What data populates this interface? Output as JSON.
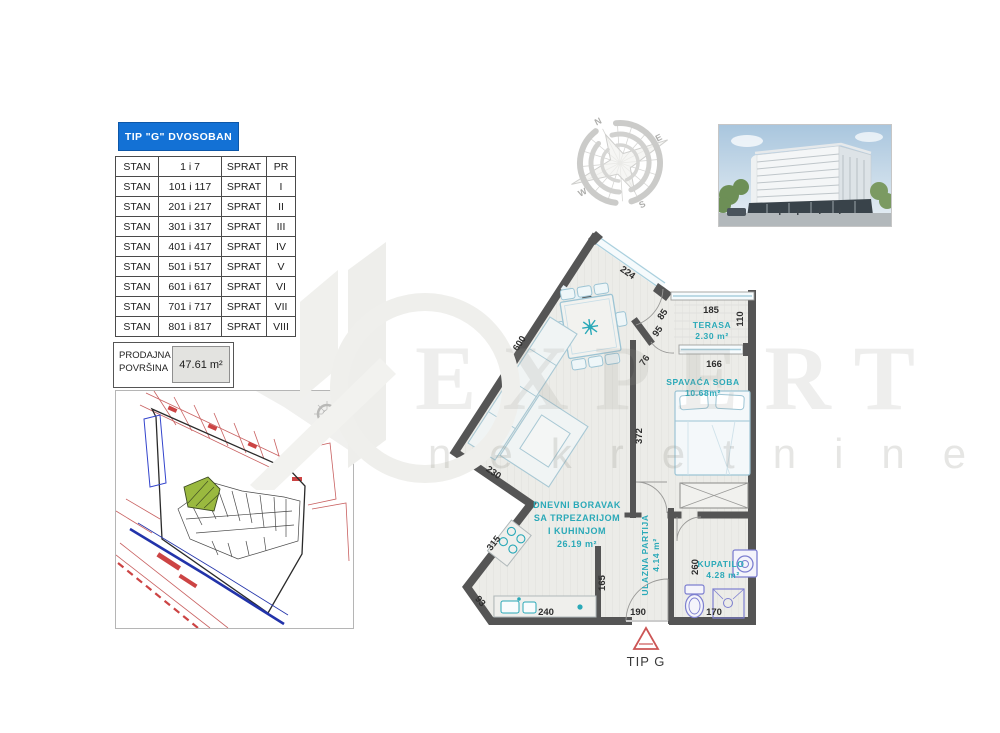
{
  "title_box": {
    "label": "TIP \"G\" DVOSOBAN"
  },
  "apartments_table": {
    "rows": [
      {
        "c1": "STAN",
        "c2": "1 i 7",
        "c3": "SPRAT",
        "c4": "PR"
      },
      {
        "c1": "STAN",
        "c2": "101 i 117",
        "c3": "SPRAT",
        "c4": "I"
      },
      {
        "c1": "STAN",
        "c2": "201 i 217",
        "c3": "SPRAT",
        "c4": "II"
      },
      {
        "c1": "STAN",
        "c2": "301 i 317",
        "c3": "SPRAT",
        "c4": "III"
      },
      {
        "c1": "STAN",
        "c2": "401 i 417",
        "c3": "SPRAT",
        "c4": "IV"
      },
      {
        "c1": "STAN",
        "c2": "501 i 517",
        "c3": "SPRAT",
        "c4": "V"
      },
      {
        "c1": "STAN",
        "c2": "601 i 617",
        "c3": "SPRAT",
        "c4": "VI"
      },
      {
        "c1": "STAN",
        "c2": "701 i 717",
        "c3": "SPRAT",
        "c4": "VII"
      },
      {
        "c1": "STAN",
        "c2": "801 i 817",
        "c3": "SPRAT",
        "c4": "VIII"
      }
    ]
  },
  "area_box": {
    "label": "PRODAJNA POVRŠINA",
    "value": "47.61 m²"
  },
  "compass": {
    "n": "N",
    "e": "E",
    "s": "S",
    "w": "W"
  },
  "floor_plan": {
    "type_label": "TIP G",
    "rooms": {
      "living": {
        "line1": "DNEVNI BORAVAK",
        "line2": "SA TRPEZARIJOM",
        "line3": "I KUHINJOM",
        "area": "26.19 m²"
      },
      "terrace": {
        "name": "TERASA",
        "area": "2.30 m²"
      },
      "bedroom": {
        "name": "SPAVAĆA SOBA",
        "area": "10.68m²"
      },
      "hall": {
        "name": "ULAZNA PARTIJA",
        "area": "4.14 m²"
      },
      "bathroom": {
        "name": "KUPATILO",
        "area": "4.28 m²"
      }
    },
    "dims": {
      "d224": "224",
      "d600": "600",
      "d230": "230",
      "d315": "315",
      "d93": "93",
      "d240": "240",
      "d165": "165",
      "d190": "190",
      "d170": "170",
      "d260": "260",
      "d185": "185",
      "d110": "110",
      "d166": "166",
      "d372": "372",
      "d85": "85",
      "d95": "95",
      "d76": "76"
    }
  },
  "watermark": {
    "brand": "EXPERT",
    "subtitle": "nekretnine"
  },
  "colors": {
    "accent_blue": "#1371d5",
    "wall": "#555555",
    "room_label": "#2aa9b8",
    "fixture_purple": "#7d7fd0",
    "marker_red": "#cc5555",
    "site_red": "#c86060",
    "site_blue": "#2233aa",
    "site_green": "#9ab93f"
  }
}
